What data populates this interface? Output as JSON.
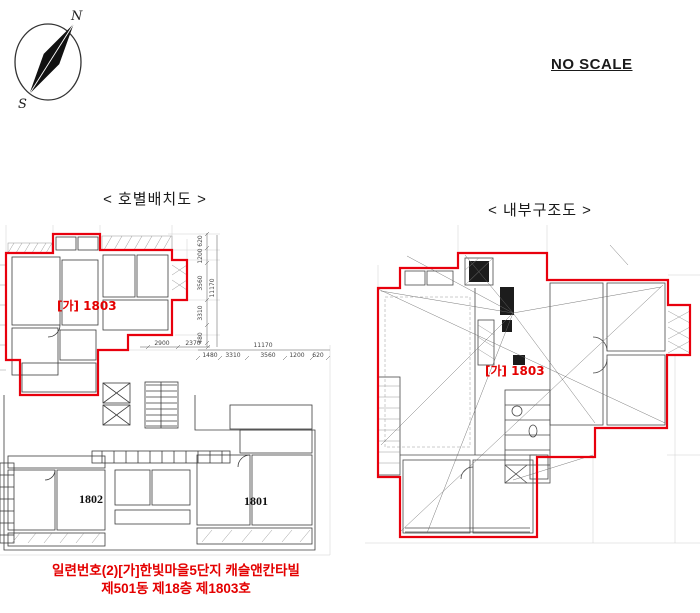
{
  "scale_note": "NO SCALE",
  "compass": {
    "north": "N",
    "south": "S"
  },
  "left_plan": {
    "title": "< 호별배치도 >",
    "unit_label": "[가] 1803",
    "unit_left": "1802",
    "unit_right": "1801",
    "dims": {
      "v_chain": [
        "620",
        "1200",
        "3560",
        "3310",
        "480"
      ],
      "v_overall": "11170",
      "h_upper": [
        "2900",
        "2370"
      ],
      "h_overall": "11170",
      "h_lower": [
        "1480",
        "3310",
        "3560",
        "1200",
        "620"
      ]
    }
  },
  "right_plan": {
    "title": "< 내부구조도 >",
    "unit_label": "[가] 1803"
  },
  "caption": {
    "line1": "일련번호(2)[가]한빛마을5단지  캐슬앤칸타빌",
    "line2": "제501동 제18층 제1803호"
  },
  "colors": {
    "outline_red": "#e8000d",
    "caption_red": "#e40000"
  }
}
